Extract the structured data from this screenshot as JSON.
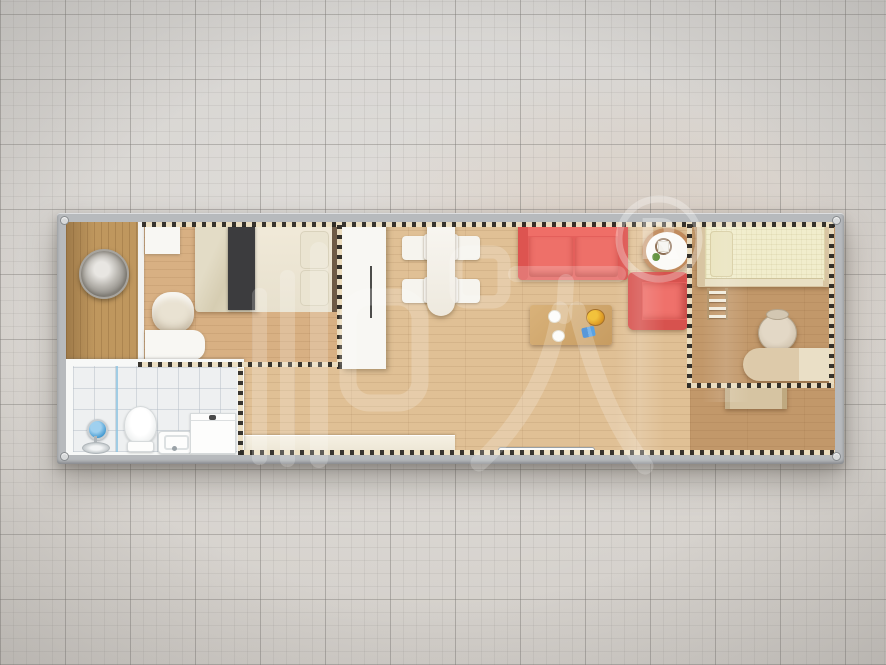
{
  "scene": {
    "description": "Top-down 3D rendering of a single-module container house floor plan on a gray graph-paper background",
    "brand_watermark": "柜族",
    "registered_mark": "®",
    "registered_letter": "R"
  },
  "palette": {
    "frame": "#b7babd",
    "wall": "#f2f2f0",
    "tile": "#eef0f1",
    "wood-living": "#e0c095",
    "wood-right": "#c2986a",
    "wood-bedroom": "#d8b083",
    "wood-entry": "#bf975e",
    "white-furniture": "#f8f7f3",
    "red-sofa": "#e45f5b",
    "dash-dark": "#2e2b26",
    "dash-light": "#ecdfc2",
    "cream-bed": "#f1edcc",
    "desk-wood": "#ddcaaa",
    "coffee-table": "#d0a76d"
  },
  "plan_contents": {
    "rooms": [
      {
        "name": "entry-porch",
        "floor": "vertical dark wood",
        "items": [
          "round metal wall decor"
        ]
      },
      {
        "name": "bedroom-1",
        "floor": "light wood",
        "items": [
          "double bed with dark runner",
          "wall shelf",
          "desk",
          "chair"
        ]
      },
      {
        "name": "bathroom",
        "floor": "white tile",
        "items": [
          "shower head and drain",
          "toilet",
          "wall-hung sink",
          "cabinet-washer"
        ]
      },
      {
        "name": "living-dining",
        "floor": "light wood",
        "items": [
          "dining table",
          "4 chairs",
          "red sofa",
          "red armchair",
          "round side table with cup and plant",
          "wood coffee table with fruit bowl and dishes",
          "long bench",
          "entry door sill"
        ]
      },
      {
        "name": "bedroom-2",
        "floor": "medium wood",
        "items": [
          "single cream bed",
          "step ladder",
          "office chair",
          "desk",
          "drawer unit"
        ]
      }
    ]
  }
}
